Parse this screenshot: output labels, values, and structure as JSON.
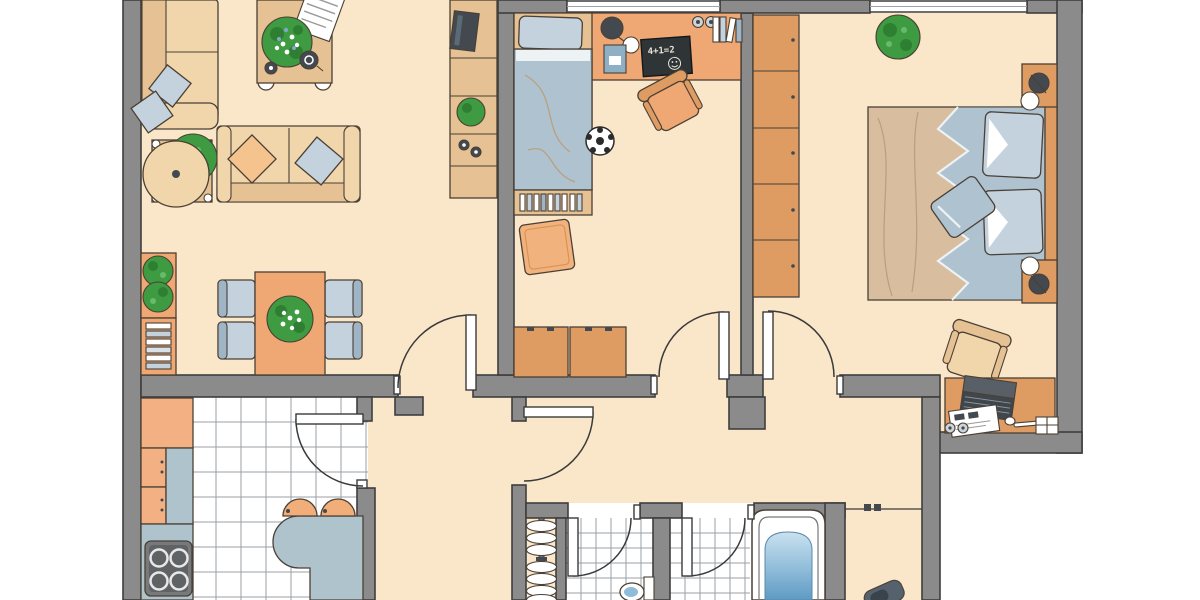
{
  "title": "apartment-floor-plan",
  "text": {
    "blackboard": "4+1=2"
  },
  "palette": {
    "floor": "#FAE6C9",
    "wall": "#8B8B8B",
    "wallEdge": "#3E3E3E",
    "outline": "#4A4036",
    "tan": "#F2D6AB",
    "tanDark": "#E5C193",
    "orange": "#EFA873",
    "orangeDark": "#DE9C63",
    "blueGray": "#AEC2CF",
    "blueLight": "#C4D2DD",
    "chairBack": "#9FB4C4",
    "counter": "#AFC3CD",
    "tileLine": "#9AA0A5",
    "green": "#3E9B41",
    "greenDark": "#2F7F33",
    "dark": "#43494E",
    "bedTan": "#D8BD9E",
    "bedFold": "#BA9F7C",
    "pillowOrange": "#F5C48E",
    "cabinet": "#F3B183",
    "stool": "#F2AE79",
    "water": "#8FBCD9",
    "waterLight": "#C9E2F0",
    "chalkboard": "#2F3437",
    "chalk": "#E9E4D6",
    "stoveBody": "#77797B",
    "stoveTop": "#606365"
  },
  "rooms": [
    {
      "id": "living-room",
      "furniture": [
        "wall-sofa",
        "two-seat-sofa",
        "coffee-table-with-plant",
        "side-table-with-plant",
        "dining-table",
        "dining-chairs-x4",
        "plant-shelf",
        "bookshelf",
        "tv-sideboard"
      ]
    },
    {
      "id": "kids-room",
      "furniture": [
        "single-bed",
        "desk",
        "desk-lamp",
        "blackboard",
        "desk-chair",
        "soccer-ball",
        "book-shelf",
        "floor-cushion",
        "drawer-chests-x2"
      ]
    },
    {
      "id": "bedroom",
      "furniture": [
        "wardrobe",
        "double-bed",
        "nightstands-x2",
        "bedside-lamps-x2",
        "plant",
        "laptop-desk",
        "desk-chair"
      ]
    },
    {
      "id": "kitchen",
      "furniture": [
        "corner-cabinet",
        "base-cabinets",
        "counter",
        "stove",
        "island-counter",
        "bar-stools-x2"
      ]
    },
    {
      "id": "hallway",
      "furniture": [
        "coat-rack"
      ]
    },
    {
      "id": "wc",
      "furniture": [
        "toilet"
      ]
    },
    {
      "id": "bathroom",
      "furniture": [
        "bathtub"
      ]
    }
  ],
  "counts": {
    "windows": 2,
    "doors": 7
  }
}
